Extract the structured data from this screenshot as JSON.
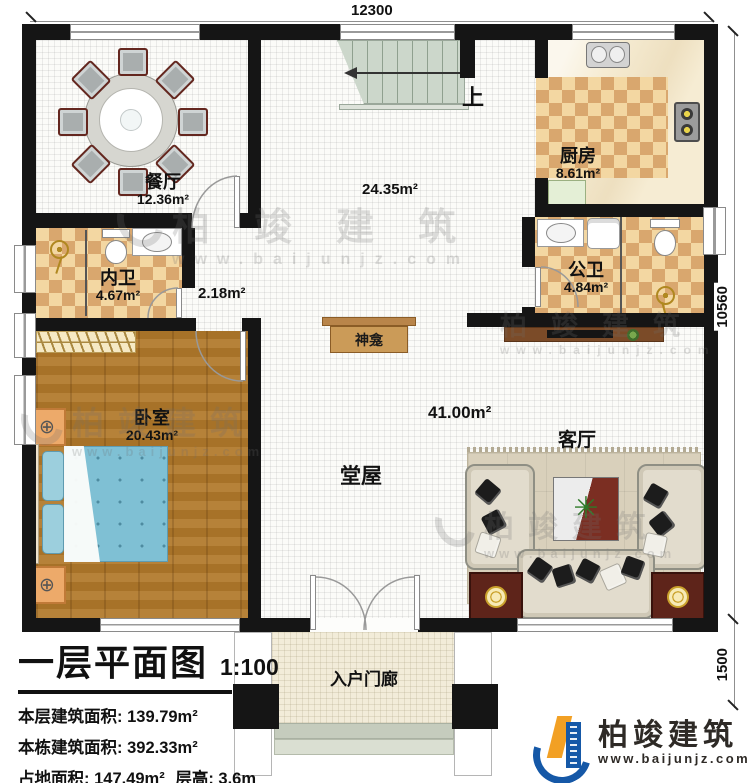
{
  "dimensions": {
    "top": "12300",
    "right_main": "10560",
    "right_porch": "1500"
  },
  "rooms": {
    "dining": {
      "name": "餐厅",
      "area": "12.36m²"
    },
    "kitchen": {
      "name": "厨房",
      "area": "8.61m²"
    },
    "inner_bath": {
      "name": "内卫",
      "area": "4.67m²"
    },
    "public_bath": {
      "name": "公卫",
      "area": "4.84m²"
    },
    "bedroom": {
      "name": "卧室",
      "area": "20.43m²"
    },
    "hall": {
      "name": "堂屋",
      "area": "41.00m²"
    },
    "living": {
      "name": "客厅"
    },
    "porch": {
      "name": "入户门廊"
    },
    "hall_upper_area": "24.35m²",
    "corridor_area": "2.18m²",
    "shrine": "神龛",
    "stairs_up": "上"
  },
  "title_block": {
    "title": "一层平面图",
    "scale": "1:100",
    "stats": [
      {
        "label": "本层建筑面积:",
        "value": "139.79m²"
      },
      {
        "label": "本栋建筑面积:",
        "value": "392.33m²"
      },
      {
        "label": "占地面积:",
        "value": "147.49m²",
        "label2": "层高:",
        "value2": "3.6m"
      }
    ]
  },
  "brand": {
    "name": "柏竣建筑",
    "url": "www.baijunjz.com"
  },
  "watermark": {
    "name": "柏竣建筑",
    "url": "www.baijunjz.com"
  },
  "colors": {
    "wall": "#151515",
    "logo_blue": "#1558a7",
    "logo_orange": "#f2a024",
    "bed": "#7fc0d4",
    "wood": "#b0782a"
  }
}
